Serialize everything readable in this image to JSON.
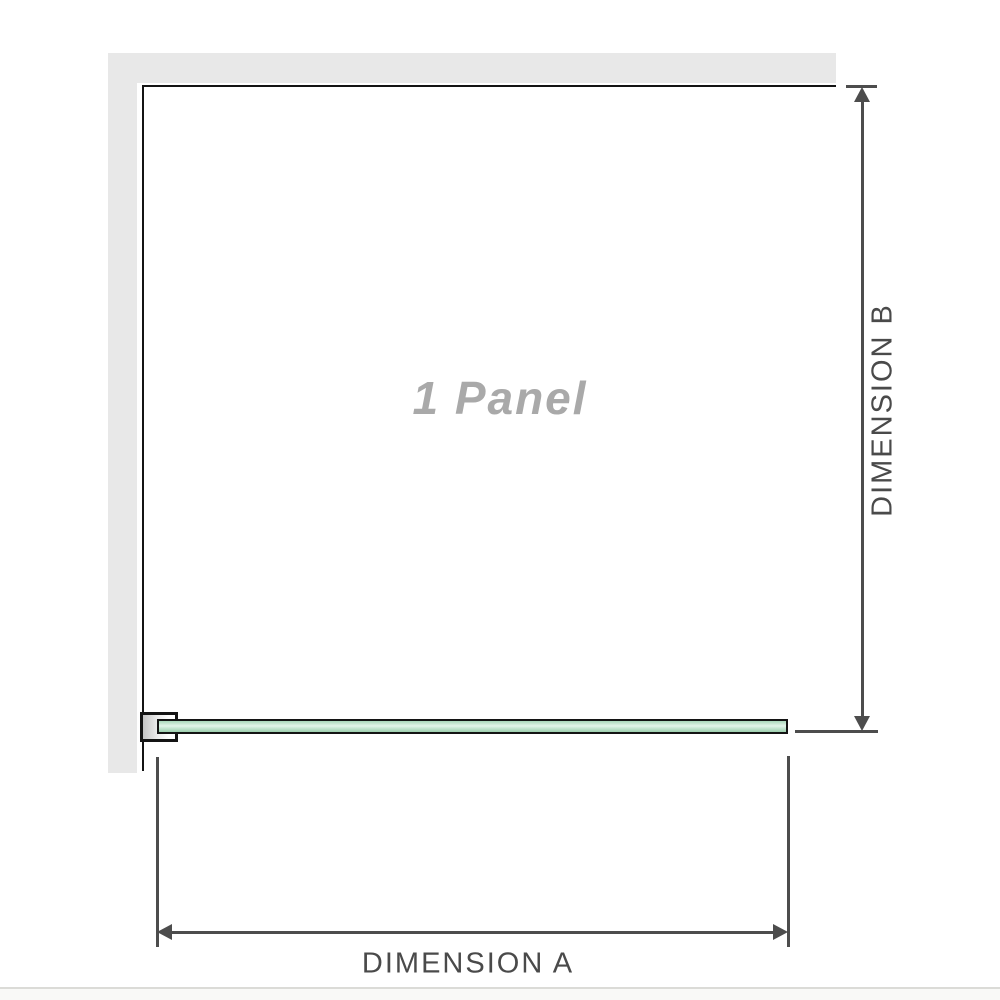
{
  "diagram": {
    "title": "1 Panel",
    "dimension_a": "DIMENSION A",
    "dimension_b": "DIMENSION B"
  },
  "colors": {
    "background": "#ffffff",
    "wall": "#e8e8e8",
    "edge": "#141414",
    "dimension": "#4d4d4d",
    "label_text": "#4a4a4a",
    "panel_text": "#a9a9a9",
    "glass_border": "#141414",
    "glass_top": "#a9d7ba",
    "glass_mid": "#e4f4ea",
    "glass_bottom": "#9ccfae",
    "bracket_fill_dark": "#c4c4c4",
    "bracket_fill_light": "#ffffff",
    "baseline": "#dbdbd7"
  }
}
